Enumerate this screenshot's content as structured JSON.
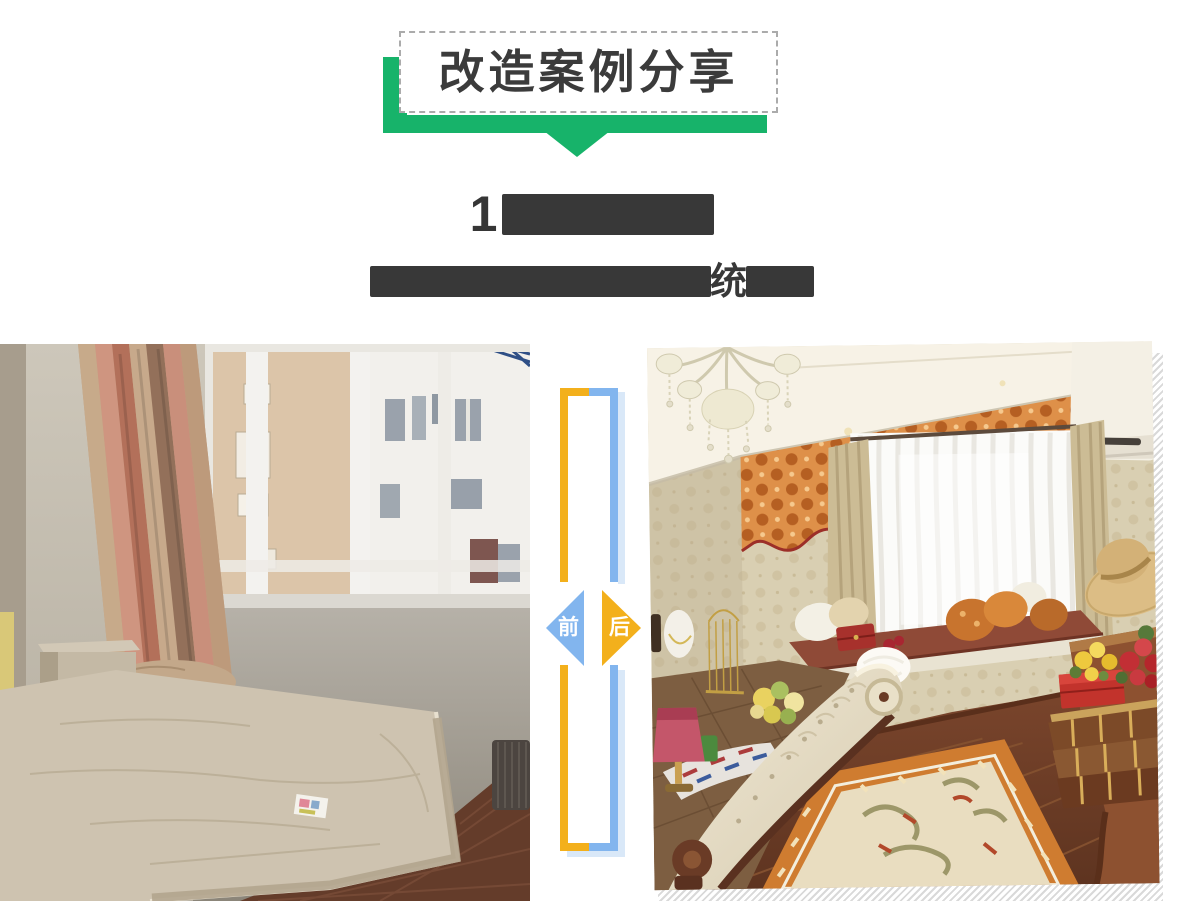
{
  "banner": {
    "title": "改造案例分享",
    "ribbon_color": "#17b36a",
    "box_border_color": "#ababab",
    "title_color": "#3b3b3b"
  },
  "heading": {
    "line1_visible": "1",
    "line1_redacted": true,
    "line2_redacted": true,
    "line2_visible_fragment": "统",
    "redaction_color": "#383838"
  },
  "divider": {
    "before_label": "前",
    "after_label": "后",
    "before_triangle_color": "#82b5ee",
    "after_triangle_color": "#f3b01c",
    "frame_left_color": "#f3b01c",
    "frame_right_color": "#82b5ee",
    "frame_shadow_color": "#d9e8f8"
  },
  "photos": {
    "before": {
      "description": "改造前卧室照片：空房间、裸床垫、窗外楼房"
    },
    "after": {
      "description": "改造后卧室照片：水晶吊灯、橙色窗幔、飘窗坐垫、地毯"
    },
    "hatch_stripe_color": "#d9d9d9"
  }
}
